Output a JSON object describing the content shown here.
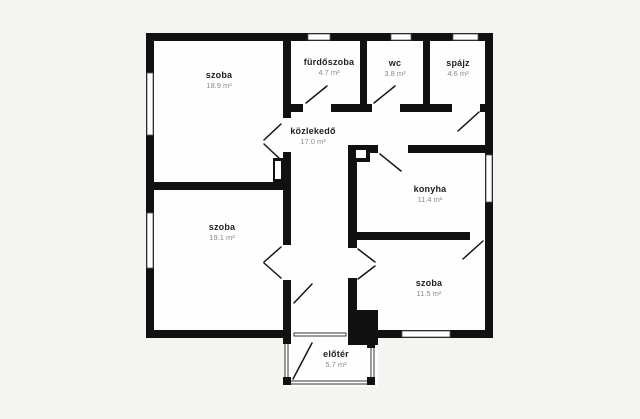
{
  "floorplan": {
    "background_color": "#f4f4f1",
    "wall_color": "#111111",
    "floor_color": "#fefefe",
    "rooms": [
      {
        "id": "szoba-top-left",
        "name": "szoba",
        "area": "18.9 m²"
      },
      {
        "id": "furdoszoba",
        "name": "fürdőszoba",
        "area": "4.7 m²"
      },
      {
        "id": "wc",
        "name": "wc",
        "area": "3.8 m²"
      },
      {
        "id": "spajz",
        "name": "spájz",
        "area": "4.6 m²"
      },
      {
        "id": "kozlekedo",
        "name": "közlekedő",
        "area": "17.0 m²"
      },
      {
        "id": "konyha",
        "name": "konyha",
        "area": "11.4 m²"
      },
      {
        "id": "szoba-bottom-left",
        "name": "szoba",
        "area": "19.1 m²"
      },
      {
        "id": "szoba-bottom-right",
        "name": "szoba",
        "area": "11.5 m²"
      },
      {
        "id": "eloter",
        "name": "előtér",
        "area": "5.7 m²"
      }
    ]
  }
}
